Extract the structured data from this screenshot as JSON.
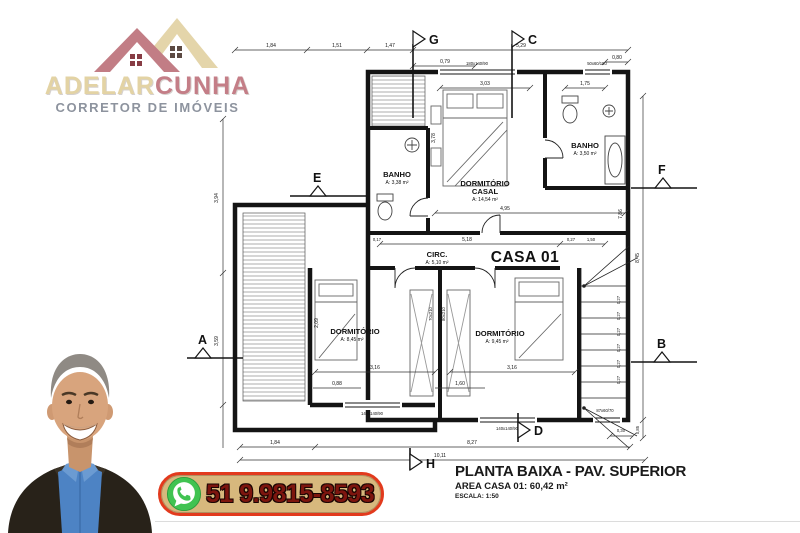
{
  "brand": {
    "name_primary": "ADELAR",
    "name_secondary": "CUNHA",
    "tagline": "CORRETOR DE IMÓVEIS",
    "colors": {
      "primary": "#e3d3a4",
      "secondary": "#c47e87",
      "tagline": "#8d939e"
    }
  },
  "icons": {
    "logo": "house-roofs-icon",
    "whatsapp": "whatsapp-icon"
  },
  "contact": {
    "phone": "51 9.9815-8593",
    "banner_bg": "#d7b87d",
    "banner_border": "#e23a1d",
    "phone_color": "#7d150e",
    "whatsapp_green": "#40c351"
  },
  "title_block": {
    "title": "PLANTA BAIXA - PAV. SUPERIOR",
    "area": "AREA CASA 01: 60,42 m²",
    "scale": "ESCALA: 1:50"
  },
  "floor_plan": {
    "unit_label": "CASA 01",
    "rooms": [
      {
        "name": "BANHO",
        "area": "A: 3,38 m²"
      },
      {
        "name": "DORMITÓRIO",
        "name2": "CASAL",
        "area": "A: 14,54 m²"
      },
      {
        "name": "BANHO",
        "area": "A: 3,50 m²"
      },
      {
        "name": "CIRC.",
        "area": "A: 5,10 m²"
      },
      {
        "name": "DORMITÓRIO",
        "area": "A: 8,45 m²"
      },
      {
        "name": "DORMITÓRIO",
        "area": "A: 9,45 m²"
      }
    ],
    "markers": [
      "G",
      "C",
      "E",
      "F",
      "A",
      "B",
      "D",
      "H"
    ],
    "dims": {
      "top": [
        "1,84",
        "1,51",
        "1,47",
        "5,29"
      ],
      "upper": [
        "0,79",
        "0,80",
        "3,03",
        "1,75"
      ],
      "left": [
        "3,94",
        "3,59"
      ],
      "right": [
        "8,45",
        "0,85"
      ],
      "middle": [
        "4,95",
        "5,18",
        "0,27",
        "1,50",
        "0,17"
      ],
      "lower": [
        "3,16",
        "3,16",
        "1,60",
        "0,88"
      ],
      "bottom": [
        "1,84",
        "8,27",
        "10,11",
        "0,30"
      ],
      "rotated": [
        "3,78",
        "7,86",
        "2,09"
      ],
      "door_labels": [
        "70x210",
        "80x210"
      ],
      "window_labels": [
        "180x140/90",
        "50x60/150",
        "140x140/90",
        "140x140/90",
        "87x60/70"
      ],
      "stair_step": "0,27"
    }
  }
}
